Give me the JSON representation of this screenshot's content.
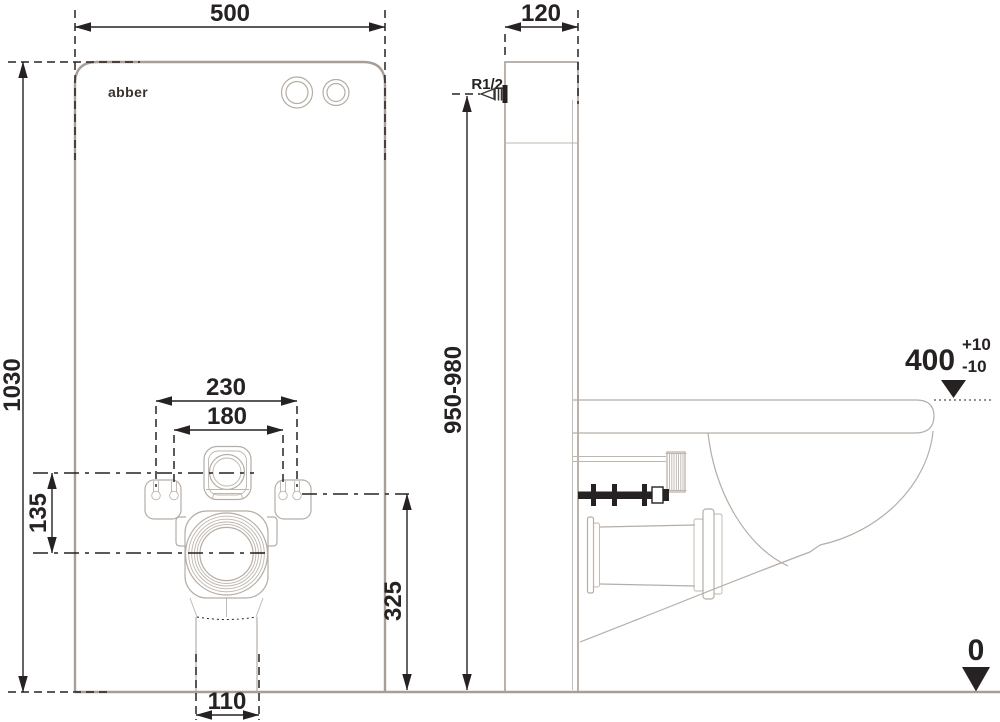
{
  "brand": {
    "logo": "abber"
  },
  "front_view": {
    "width": "500",
    "height": "1030",
    "inlet_spacing": "230",
    "bolt_spacing": "180",
    "inlet_to_drain": "135",
    "connection_height": "325",
    "outlet_width": "110"
  },
  "side_view": {
    "depth": "120",
    "module_height": "950-980",
    "water_inlet": "R1/2",
    "bowl_height": "400",
    "bowl_height_tol_plus": "+10",
    "bowl_height_tol_minus": "-10",
    "floor_level": "0"
  },
  "colors": {
    "dimension_black": "#262222",
    "panel_gray": "#a89e96",
    "fixture_gray": "#b6ada5"
  }
}
